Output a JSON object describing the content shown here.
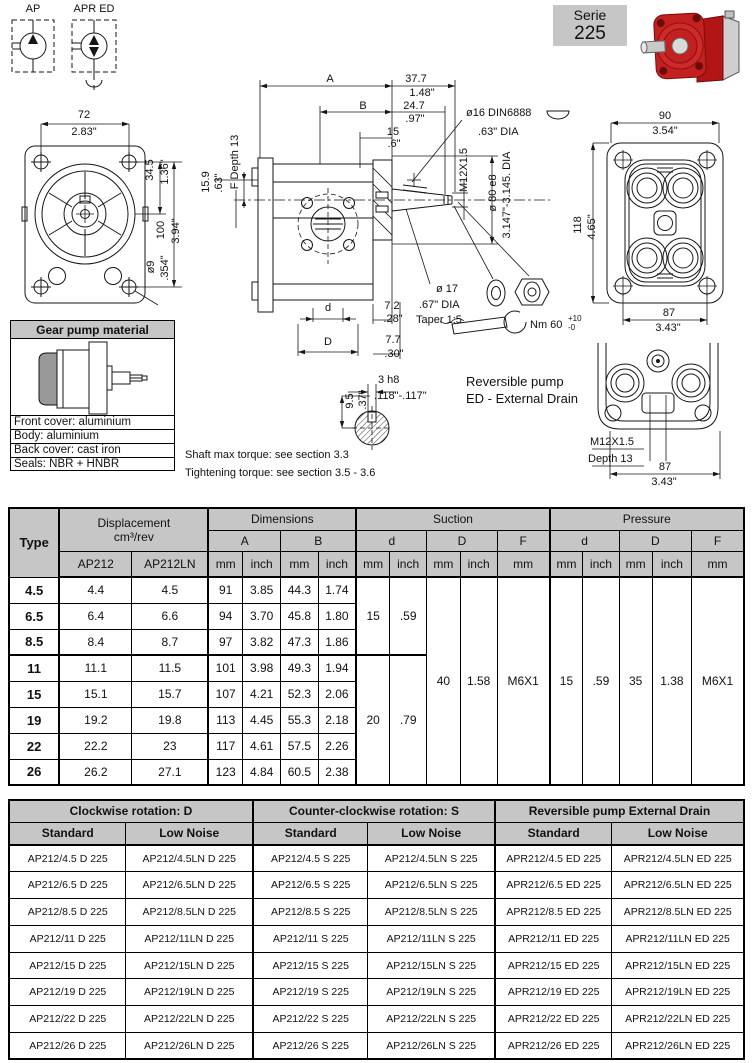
{
  "symbols": {
    "ap": "AP",
    "apr_ed": "APR ED"
  },
  "serie": {
    "line1": "Serie",
    "line2": "225"
  },
  "front_view": {
    "w_mm": "72",
    "w_in": "2.83\"",
    "c_mm": "34.5",
    "c_in": "1.36\"",
    "h_mm": "100",
    "h_in": "3.94\"",
    "hole_mm": "ø9",
    "hole_in": ".354\""
  },
  "side_view": {
    "a": "A",
    "b": "B",
    "len1_mm": "37.7",
    "len1_in": "1.48\"",
    "len2_mm": "24.7",
    "len2_in": ".97\"",
    "len3_mm": "15",
    "len3_in": ".6\"",
    "shaft_mm": "15.9",
    "shaft_in": ".63\"",
    "f_depth": "F Depth 13",
    "thread": "M12X1.5",
    "key": "ø16 DIN6888",
    "key_in": ".63\" DIA",
    "pilot": "ø 80 e8",
    "pilot_in": "3.147\"-3.145. DIA",
    "taper_d": "ø 17",
    "taper_in": ".67\" DIA",
    "taper": "Taper 1:5",
    "torque": "Nm 60",
    "torque_plus": "+10",
    "torque_minus": "-0",
    "d_small": "d",
    "port1_mm": "7.2",
    "port1_in": ".28\"",
    "d_big": "D",
    "port2_mm": "7.7",
    "port2_in": ".30\""
  },
  "back_view": {
    "w_mm": "90",
    "w_in": "3.54\"",
    "h_mm": "118",
    "h_in": "4.65\"",
    "b_mm": "87",
    "b_in": "3.43\""
  },
  "reversible_view": {
    "title1": "Reversible pump",
    "title2": "ED - External Drain",
    "thread": "M12X1.5",
    "depth": "Depth 13",
    "w_mm": "87",
    "w_in": "3.43\""
  },
  "key_section": {
    "top": "3 h8",
    "range": ".118\"-.117\"",
    "h_mm": "9.5",
    "h_in": ".37\""
  },
  "notes": {
    "note1": "Shaft max torque: see section 3.3",
    "note2": "Tightening torque: see section 3.5 - 3.6"
  },
  "material_box": {
    "title": "Gear pump material",
    "rows": [
      "Front cover: aluminium",
      "Body: aluminium",
      "Back cover: cast iron",
      "Seals: NBR + HNBR"
    ]
  },
  "dim_table": {
    "type_h": "Type",
    "disp_h1": "Displacement",
    "disp_h2": "cm³/rev",
    "disp_cols": [
      "AP212",
      "AP212LN"
    ],
    "dims_h": "Dimensions",
    "suction_h": "Suction",
    "pressure_h": "Pressure",
    "sub_a": "A",
    "sub_b": "B",
    "sub_d": "d",
    "sub_dd": "D",
    "sub_f": "F",
    "mm": "mm",
    "inch": "inch",
    "rows": [
      {
        "t": "4.5",
        "ap": "4.4",
        "ln": "4.5",
        "amm": "91",
        "ain": "3.85",
        "bmm": "44.3",
        "bin": "1.74"
      },
      {
        "t": "6.5",
        "ap": "6.4",
        "ln": "6.6",
        "amm": "94",
        "ain": "3.70",
        "bmm": "45.8",
        "bin": "1.80"
      },
      {
        "t": "8.5",
        "ap": "8.4",
        "ln": "8.7",
        "amm": "97",
        "ain": "3.82",
        "bmm": "47.3",
        "bin": "1.86"
      },
      {
        "t": "11",
        "ap": "11.1",
        "ln": "11.5",
        "amm": "101",
        "ain": "3.98",
        "bmm": "49.3",
        "bin": "1.94"
      },
      {
        "t": "15",
        "ap": "15.1",
        "ln": "15.7",
        "amm": "107",
        "ain": "4.21",
        "bmm": "52.3",
        "bin": "2.06"
      },
      {
        "t": "19",
        "ap": "19.2",
        "ln": "19.8",
        "amm": "113",
        "ain": "4.45",
        "bmm": "55.3",
        "bin": "2.18"
      },
      {
        "t": "22",
        "ap": "22.2",
        "ln": "23",
        "amm": "117",
        "ain": "4.61",
        "bmm": "57.5",
        "bin": "2.26"
      },
      {
        "t": "26",
        "ap": "26.2",
        "ln": "27.1",
        "amm": "123",
        "ain": "4.84",
        "bmm": "60.5",
        "bin": "2.38"
      }
    ],
    "suction": {
      "d_groups": [
        {
          "mm": "15",
          "in": ".59",
          "span": 3
        },
        {
          "mm": "20",
          "in": ".79",
          "span": 5
        }
      ],
      "D": {
        "mm": "40",
        "in": "1.58"
      },
      "F": "M6X1"
    },
    "pressure": {
      "d": {
        "mm": "15",
        "in": ".59"
      },
      "D": {
        "mm": "35",
        "in": "1.38"
      },
      "F": "M6X1"
    }
  },
  "order_table": {
    "groups": [
      "Clockwise rotation: D",
      "Counter-clockwise rotation: S",
      "Reversible pump External Drain"
    ],
    "sub": [
      "Standard",
      "Low Noise",
      "Standard",
      "Low Noise",
      "Standard",
      "Low Noise"
    ],
    "rows": [
      [
        "AP212/4.5 D 225",
        "AP212/4.5LN D 225",
        "AP212/4.5 S 225",
        "AP212/4.5LN S 225",
        "APR212/4.5 ED 225",
        "APR212/4.5LN ED 225"
      ],
      [
        "AP212/6.5 D 225",
        "AP212/6.5LN D 225",
        "AP212/6.5 S 225",
        "AP212/6.5LN S 225",
        "APR212/6.5 ED 225",
        "APR212/6.5LN ED 225"
      ],
      [
        "AP212/8.5 D 225",
        "AP212/8.5LN D 225",
        "AP212/8.5 S 225",
        "AP212/8.5LN S 225",
        "APR212/8.5 ED 225",
        "APR212/8.5LN ED 225"
      ],
      [
        "AP212/11 D 225",
        "AP212/11LN D 225",
        "AP212/11 S 225",
        "AP212/11LN S 225",
        "APR212/11 ED 225",
        "APR212/11LN ED 225"
      ],
      [
        "AP212/15 D 225",
        "AP212/15LN D 225",
        "AP212/15 S 225",
        "AP212/15LN S 225",
        "APR212/15 ED 225",
        "APR212/15LN ED 225"
      ],
      [
        "AP212/19 D 225",
        "AP212/19LN D 225",
        "AP212/19 S 225",
        "AP212/19LN S 225",
        "APR212/19 ED 225",
        "APR212/19LN ED 225"
      ],
      [
        "AP212/22 D 225",
        "AP212/22LN D 225",
        "AP212/22 S 225",
        "AP212/22LN S 225",
        "APR212/22 ED 225",
        "APR212/22LN ED 225"
      ],
      [
        "AP212/26 D 225",
        "AP212/26LN D 225",
        "AP212/26 S 225",
        "AP212/26LN S 225",
        "APR212/26 ED 225",
        "APR212/26LN ED 225"
      ]
    ]
  },
  "colors": {
    "header_gray": "#c6c6c6",
    "pump_red": "#c32020"
  }
}
